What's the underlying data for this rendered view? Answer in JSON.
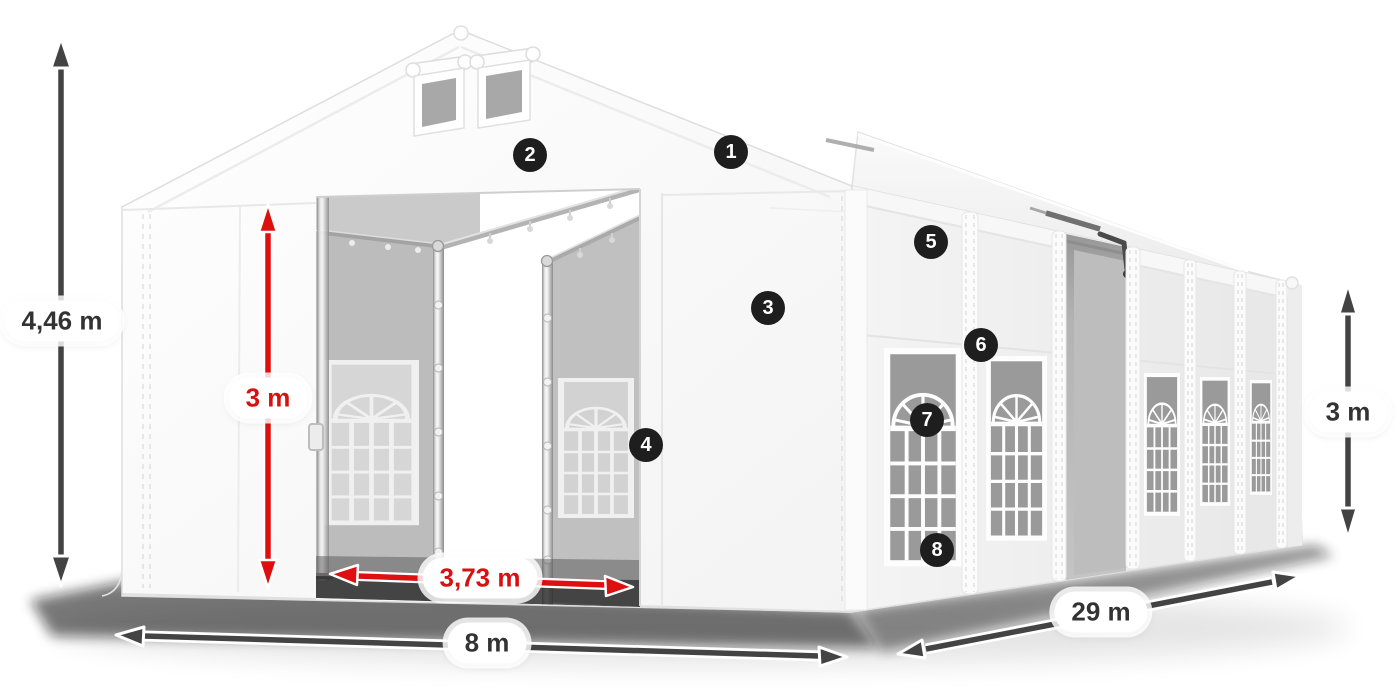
{
  "page": {
    "background": "#ffffff",
    "description": "3D product diagram of a white storage tent with dimension arrows and numbered feature callouts"
  },
  "dimensions": {
    "total_height": "4,46 m",
    "entrance_height": "3 m",
    "entrance_width": "3,73 m",
    "width": "8 m",
    "length": "29 m",
    "side_wall_height": "3 m"
  },
  "callouts": [
    {
      "number": "1"
    },
    {
      "number": "2"
    },
    {
      "number": "3"
    },
    {
      "number": "4"
    },
    {
      "number": "5"
    },
    {
      "number": "6"
    },
    {
      "number": "7"
    },
    {
      "number": "8"
    }
  ],
  "colors": {
    "dimension_arrow_red": "#dd0f0f",
    "dimension_arrow_dark": "#434343",
    "dimension_label_text_dark": "#333333",
    "dimension_label_text_red": "#d8100f",
    "badge_background": "#1e1e1e",
    "badge_text": "#ffffff",
    "tent_fabric_white": "#ffffff",
    "tent_interior_gray": "#bfbfbf",
    "window_glass_gray": "#9a9a9a"
  }
}
